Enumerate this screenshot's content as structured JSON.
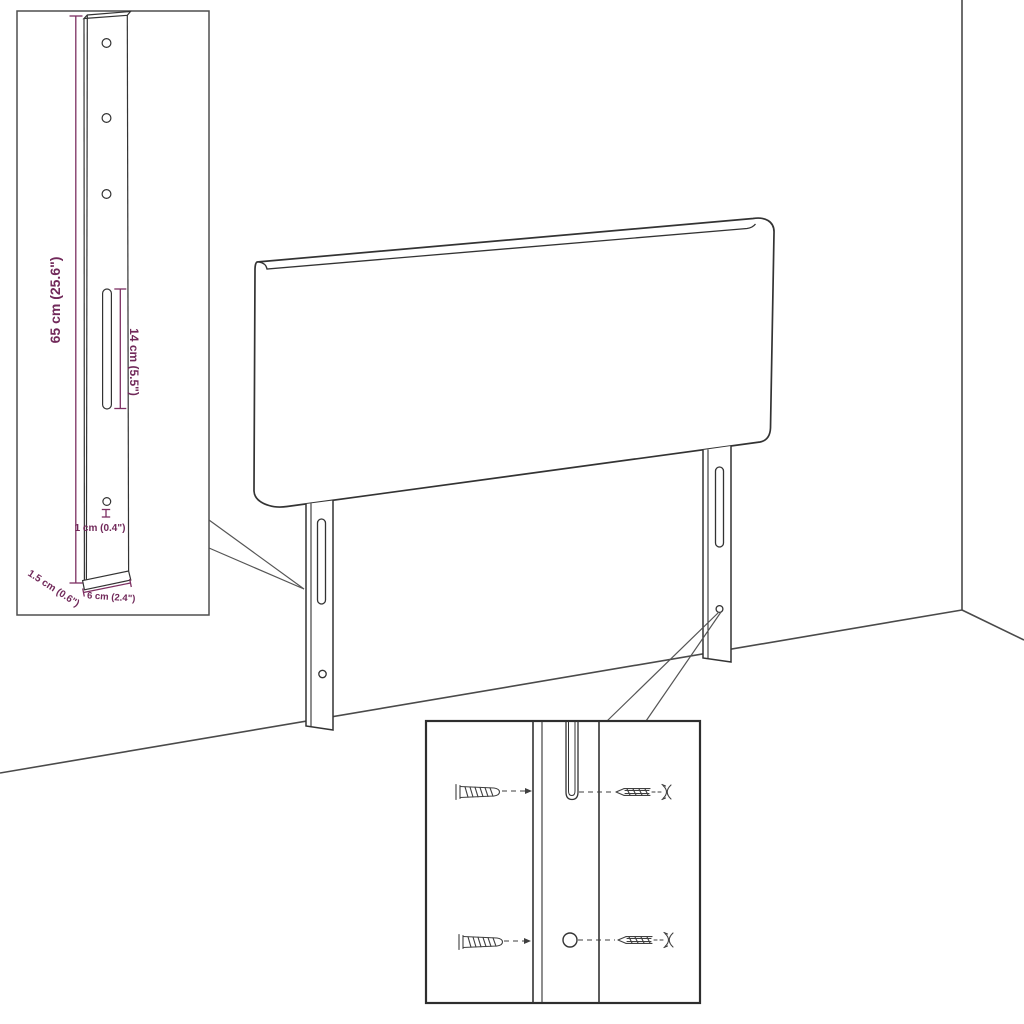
{
  "colors": {
    "outline": "#333333",
    "room_line": "#4a4a4a",
    "dimension": "#71295a",
    "background": "#ffffff"
  },
  "scene": {
    "subject": "headboard panel with two mounting legs in a room corner"
  },
  "insets": {
    "leg_detail": {
      "dimensions": {
        "height": "65 cm (25.6\")",
        "slot": "14 cm (5.5\")",
        "hole": "1 cm (0.4\")",
        "depth": "1.5 cm (0.6\")",
        "width": "6 cm (2.4\")"
      }
    },
    "mounting_detail": {
      "hardware": [
        "wall plug",
        "screw",
        "wall plug",
        "screw"
      ]
    }
  }
}
